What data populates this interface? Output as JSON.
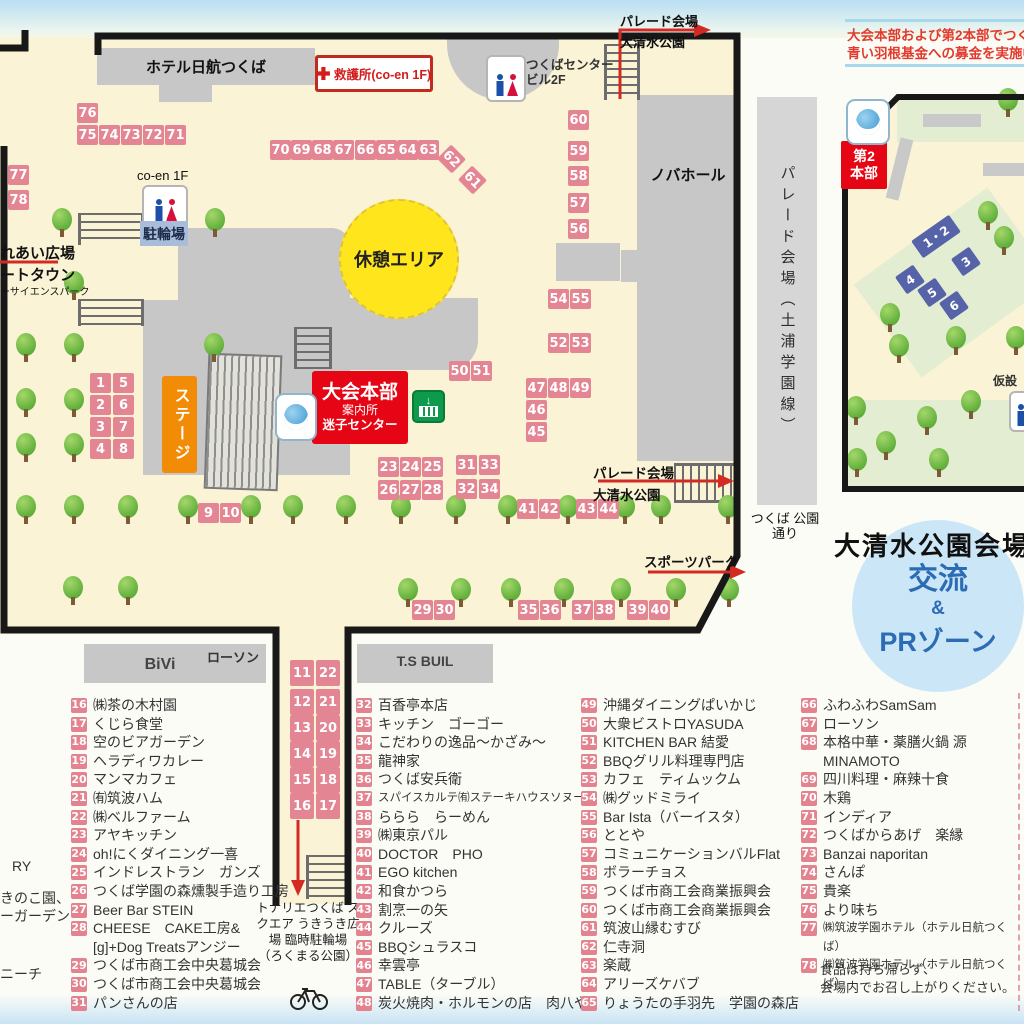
{
  "colors": {
    "booth_pink": "#e48593",
    "booth_blue": "#5663a8",
    "accent_red": "#e60514",
    "stage_orange": "#f28b05",
    "rest_yellow": "#ffe61c",
    "pr_blue": "#2c6cb5"
  },
  "donation_notice": {
    "line1": "大会本部および第2本部でつく",
    "line2": "青い羽根基金への募金を実施中"
  },
  "main_map": {
    "labels": {
      "hotel": "ホテル日航つくば",
      "aid_station": "救護所(co-en 1F)",
      "center_bldg_1": "つくばセンター",
      "center_bldg_2": "ビル2F",
      "novahall": "ノバホール",
      "coen": "co-en 1F",
      "bike_parking": "駐輪場",
      "rest_area": "休憩エリア",
      "stage": "ステージ",
      "hq_1": "大会本部",
      "hq_2": "案内所",
      "hq_3": "迷子センター",
      "fureai": "れあい広場",
      "town": "ートタウン",
      "science_park": "ーサイエンスパーク",
      "parade_1": "パレード会場",
      "parade_2": "大清水公園",
      "sports_park": "スポーツパーク",
      "park_street": "つくば 公園通り",
      "road": "パレード会場（土浦学園線）",
      "bivi": "BiVi",
      "lawson": "ローソン",
      "ts_buil": "T.S BUIL",
      "tonarie": "トナリエつくば スクエア うきうき広場 臨時駐輪場 （ろくまる公園）"
    },
    "booths": [
      {
        "n": "76",
        "x": 77,
        "y": 103
      },
      {
        "n": "75",
        "x": 77,
        "y": 125
      },
      {
        "n": "74",
        "x": 99,
        "y": 125
      },
      {
        "n": "73",
        "x": 121,
        "y": 125
      },
      {
        "n": "72",
        "x": 143,
        "y": 125
      },
      {
        "n": "71",
        "x": 165,
        "y": 125
      },
      {
        "n": "77",
        "x": 8,
        "y": 165
      },
      {
        "n": "78",
        "x": 8,
        "y": 190
      },
      {
        "n": "70",
        "x": 270,
        "y": 140
      },
      {
        "n": "69",
        "x": 291,
        "y": 140
      },
      {
        "n": "68",
        "x": 312,
        "y": 140
      },
      {
        "n": "67",
        "x": 333,
        "y": 140
      },
      {
        "n": "66",
        "x": 355,
        "y": 140
      },
      {
        "n": "65",
        "x": 376,
        "y": 140
      },
      {
        "n": "64",
        "x": 397,
        "y": 140
      },
      {
        "n": "63",
        "x": 418,
        "y": 140
      },
      {
        "n": "62",
        "x": 441,
        "y": 149,
        "r": 45
      },
      {
        "n": "61",
        "x": 462,
        "y": 170,
        "r": 45
      },
      {
        "n": "60",
        "x": 568,
        "y": 110
      },
      {
        "n": "59",
        "x": 568,
        "y": 141
      },
      {
        "n": "58",
        "x": 568,
        "y": 166
      },
      {
        "n": "57",
        "x": 568,
        "y": 193
      },
      {
        "n": "56",
        "x": 568,
        "y": 219
      },
      {
        "n": "54",
        "x": 548,
        "y": 289
      },
      {
        "n": "55",
        "x": 570,
        "y": 289
      },
      {
        "n": "52",
        "x": 548,
        "y": 333
      },
      {
        "n": "53",
        "x": 570,
        "y": 333
      },
      {
        "n": "50",
        "x": 449,
        "y": 361
      },
      {
        "n": "51",
        "x": 471,
        "y": 361
      },
      {
        "n": "47",
        "x": 526,
        "y": 378
      },
      {
        "n": "48",
        "x": 548,
        "y": 378
      },
      {
        "n": "49",
        "x": 570,
        "y": 378
      },
      {
        "n": "46",
        "x": 526,
        "y": 400
      },
      {
        "n": "45",
        "x": 526,
        "y": 422
      },
      {
        "n": "1",
        "x": 90,
        "y": 373
      },
      {
        "n": "5",
        "x": 113,
        "y": 373
      },
      {
        "n": "2",
        "x": 90,
        "y": 395
      },
      {
        "n": "6",
        "x": 113,
        "y": 395
      },
      {
        "n": "3",
        "x": 90,
        "y": 417
      },
      {
        "n": "7",
        "x": 113,
        "y": 417
      },
      {
        "n": "4",
        "x": 90,
        "y": 439
      },
      {
        "n": "8",
        "x": 113,
        "y": 439
      },
      {
        "n": "9",
        "x": 198,
        "y": 503
      },
      {
        "n": "10",
        "x": 220,
        "y": 503
      },
      {
        "n": "23",
        "x": 378,
        "y": 457
      },
      {
        "n": "24",
        "x": 400,
        "y": 457
      },
      {
        "n": "25",
        "x": 422,
        "y": 457
      },
      {
        "n": "26",
        "x": 378,
        "y": 480
      },
      {
        "n": "27",
        "x": 400,
        "y": 480
      },
      {
        "n": "28",
        "x": 422,
        "y": 480
      },
      {
        "n": "31",
        "x": 456,
        "y": 455
      },
      {
        "n": "33",
        "x": 479,
        "y": 455
      },
      {
        "n": "32",
        "x": 456,
        "y": 479
      },
      {
        "n": "34",
        "x": 479,
        "y": 479
      },
      {
        "n": "41",
        "x": 517,
        "y": 499
      },
      {
        "n": "42",
        "x": 539,
        "y": 499
      },
      {
        "n": "43",
        "x": 576,
        "y": 499
      },
      {
        "n": "44",
        "x": 598,
        "y": 499
      },
      {
        "n": "29",
        "x": 412,
        "y": 600
      },
      {
        "n": "30",
        "x": 434,
        "y": 600
      },
      {
        "n": "35",
        "x": 518,
        "y": 600
      },
      {
        "n": "36",
        "x": 540,
        "y": 600
      },
      {
        "n": "37",
        "x": 572,
        "y": 600
      },
      {
        "n": "38",
        "x": 594,
        "y": 600
      },
      {
        "n": "39",
        "x": 627,
        "y": 600
      },
      {
        "n": "40",
        "x": 649,
        "y": 600
      },
      {
        "n": "11",
        "x": 290,
        "y": 660,
        "w": 24,
        "h": 26
      },
      {
        "n": "22",
        "x": 316,
        "y": 660,
        "w": 24,
        "h": 26
      },
      {
        "n": "12",
        "x": 290,
        "y": 689,
        "w": 24,
        "h": 26
      },
      {
        "n": "21",
        "x": 316,
        "y": 689,
        "w": 24,
        "h": 26
      },
      {
        "n": "13",
        "x": 290,
        "y": 715,
        "w": 24,
        "h": 26
      },
      {
        "n": "20",
        "x": 316,
        "y": 715,
        "w": 24,
        "h": 26
      },
      {
        "n": "14",
        "x": 290,
        "y": 741,
        "w": 24,
        "h": 26
      },
      {
        "n": "19",
        "x": 316,
        "y": 741,
        "w": 24,
        "h": 26
      },
      {
        "n": "15",
        "x": 290,
        "y": 767,
        "w": 24,
        "h": 26
      },
      {
        "n": "18",
        "x": 316,
        "y": 767,
        "w": 24,
        "h": 26
      },
      {
        "n": "16",
        "x": 290,
        "y": 793,
        "w": 24,
        "h": 26
      },
      {
        "n": "17",
        "x": 316,
        "y": 793,
        "w": 24,
        "h": 26
      }
    ],
    "trees": [
      [
        52,
        208
      ],
      [
        205,
        208
      ],
      [
        64,
        271
      ],
      [
        16,
        333
      ],
      [
        64,
        333
      ],
      [
        204,
        333
      ],
      [
        16,
        388
      ],
      [
        64,
        388
      ],
      [
        16,
        433
      ],
      [
        64,
        433
      ],
      [
        16,
        495
      ],
      [
        64,
        495
      ],
      [
        118,
        495
      ],
      [
        178,
        495
      ],
      [
        241,
        495
      ],
      [
        283,
        495
      ],
      [
        336,
        495
      ],
      [
        391,
        495
      ],
      [
        446,
        495
      ],
      [
        498,
        495
      ],
      [
        558,
        495
      ],
      [
        615,
        495
      ],
      [
        651,
        495
      ],
      [
        718,
        495
      ],
      [
        63,
        576
      ],
      [
        118,
        576
      ],
      [
        398,
        578
      ],
      [
        451,
        578
      ],
      [
        501,
        578
      ],
      [
        554,
        578
      ],
      [
        611,
        578
      ],
      [
        666,
        578
      ],
      [
        719,
        578
      ]
    ]
  },
  "sub_map": {
    "hq2_1": "第2",
    "hq2_2": "本部",
    "temp_toilet": "仮設",
    "booths": [
      {
        "n": "1・2",
        "x": 913,
        "y": 226,
        "w": 46,
        "h": 21,
        "r": -35
      },
      {
        "n": "3",
        "x": 955,
        "y": 251,
        "w": 22,
        "h": 21,
        "r": -35
      },
      {
        "n": "4",
        "x": 899,
        "y": 269,
        "w": 22,
        "h": 21,
        "r": -35
      },
      {
        "n": "5",
        "x": 921,
        "y": 282,
        "w": 22,
        "h": 21,
        "r": -35
      },
      {
        "n": "6",
        "x": 943,
        "y": 295,
        "w": 22,
        "h": 21,
        "r": -35
      }
    ],
    "trees": [
      [
        998,
        88
      ],
      [
        978,
        201
      ],
      [
        994,
        226
      ],
      [
        880,
        303
      ],
      [
        946,
        326
      ],
      [
        1006,
        326
      ],
      [
        889,
        334
      ],
      [
        846,
        396
      ],
      [
        917,
        406
      ],
      [
        961,
        390
      ],
      [
        876,
        431
      ],
      [
        847,
        448
      ],
      [
        929,
        448
      ]
    ]
  },
  "oshimizu": {
    "title": "大清水公園会場",
    "circle_1": "交流",
    "circle_2": "&",
    "circle_3": "PRゾーン"
  },
  "legend": {
    "cutoff": [
      "RY",
      "きのこ園、",
      "ーガーデン",
      "ニーチ"
    ],
    "columns": [
      [
        {
          "n": "16",
          "t": "㈱茶の木村園"
        },
        {
          "n": "17",
          "t": "くじら食堂"
        },
        {
          "n": "18",
          "t": "空のビアガーデン"
        },
        {
          "n": "19",
          "t": "ヘラディワカレー"
        },
        {
          "n": "20",
          "t": "マンマカフェ"
        },
        {
          "n": "21",
          "t": "㈲筑波ハム"
        },
        {
          "n": "22",
          "t": "㈱ベルファーム"
        },
        {
          "n": "23",
          "t": "アヤキッチン"
        },
        {
          "n": "24",
          "t": "oh!にくダイニング一喜"
        },
        {
          "n": "25",
          "t": "インドレストラン　ガンズ"
        },
        {
          "n": "26",
          "t": "つくば学園の森燻製手造り工房"
        },
        {
          "n": "27",
          "t": "Beer Bar STEIN"
        },
        {
          "n": "28",
          "t": "CHEESE　CAKE工房&\n[g]+Dog Treatsアンジー"
        },
        {
          "n": "29",
          "t": "つくば市商工会中央葛城会"
        },
        {
          "n": "30",
          "t": "つくば市商工会中央葛城会"
        },
        {
          "n": "31",
          "t": "パンさんの店"
        }
      ],
      [
        {
          "n": "32",
          "t": "百香亭本店"
        },
        {
          "n": "33",
          "t": "キッチン　ゴーゴー"
        },
        {
          "n": "34",
          "t": "こだわりの逸品～かざみ～"
        },
        {
          "n": "35",
          "t": "龍神家"
        },
        {
          "n": "36",
          "t": "つくば安兵衛"
        },
        {
          "n": "37",
          "t": "スパイスカルテ㈲ステーキハウスソヌーテ"
        },
        {
          "n": "38",
          "t": "ららら　らーめん"
        },
        {
          "n": "39",
          "t": "㈱東京パル"
        },
        {
          "n": "40",
          "t": "DOCTOR　PHO"
        },
        {
          "n": "41",
          "t": "EGO kitchen"
        },
        {
          "n": "42",
          "t": "和食かつら"
        },
        {
          "n": "43",
          "t": "割烹一の矢"
        },
        {
          "n": "44",
          "t": "クルーズ"
        },
        {
          "n": "45",
          "t": "BBQシュラスコ"
        },
        {
          "n": "46",
          "t": "幸雲亭"
        },
        {
          "n": "47",
          "t": "TABLE（ターブル）"
        },
        {
          "n": "48",
          "t": "炭火焼肉・ホルモンの店　肉八や"
        }
      ],
      [
        {
          "n": "49",
          "t": "沖縄ダイニングぱいかじ"
        },
        {
          "n": "50",
          "t": "大衆ビストロYASUDA"
        },
        {
          "n": "51",
          "t": "KITCHEN BAR 結愛"
        },
        {
          "n": "52",
          "t": "BBQグリル料理専門店"
        },
        {
          "n": "53",
          "t": "カフェ　ティムックム"
        },
        {
          "n": "54",
          "t": "㈱グッドミライ"
        },
        {
          "n": "55",
          "t": "Bar Ista（バーイスタ）"
        },
        {
          "n": "56",
          "t": "ととや"
        },
        {
          "n": "57",
          "t": "コミュニケーションバルFlat"
        },
        {
          "n": "58",
          "t": "ボラーチョス"
        },
        {
          "n": "59",
          "t": "つくば市商工会商業振興会"
        },
        {
          "n": "60",
          "t": "つくば市商工会商業振興会"
        },
        {
          "n": "61",
          "t": "筑波山縁むすび"
        },
        {
          "n": "62",
          "t": "仁寺洞"
        },
        {
          "n": "63",
          "t": "楽蔵"
        },
        {
          "n": "64",
          "t": "アリーズケバブ"
        },
        {
          "n": "65",
          "t": "りょうたの手羽先　学園の森店"
        }
      ],
      [
        {
          "n": "66",
          "t": "ふわふわSamSam"
        },
        {
          "n": "67",
          "t": "ローソン"
        },
        {
          "n": "68",
          "t": "本格中華・薬膳火鍋 源MINAMOTO"
        },
        {
          "n": "69",
          "t": "四川料理・麻辣十食"
        },
        {
          "n": "70",
          "t": "木鶏"
        },
        {
          "n": "71",
          "t": "インディア"
        },
        {
          "n": "72",
          "t": "つくばからあげ　楽縁"
        },
        {
          "n": "73",
          "t": "Banzai naporitan"
        },
        {
          "n": "74",
          "t": "さんぽ"
        },
        {
          "n": "75",
          "t": "貴楽"
        },
        {
          "n": "76",
          "t": "より味ち"
        },
        {
          "n": "77",
          "t": "㈱筑波学園ホテル（ホテル日航つくば）"
        },
        {
          "n": "78",
          "t": "㈱筑波学園ホテル（ホテル日航つくば）"
        }
      ]
    ],
    "note": "食品は持ち帰らず、\n会場内でお召し上がりください。"
  }
}
